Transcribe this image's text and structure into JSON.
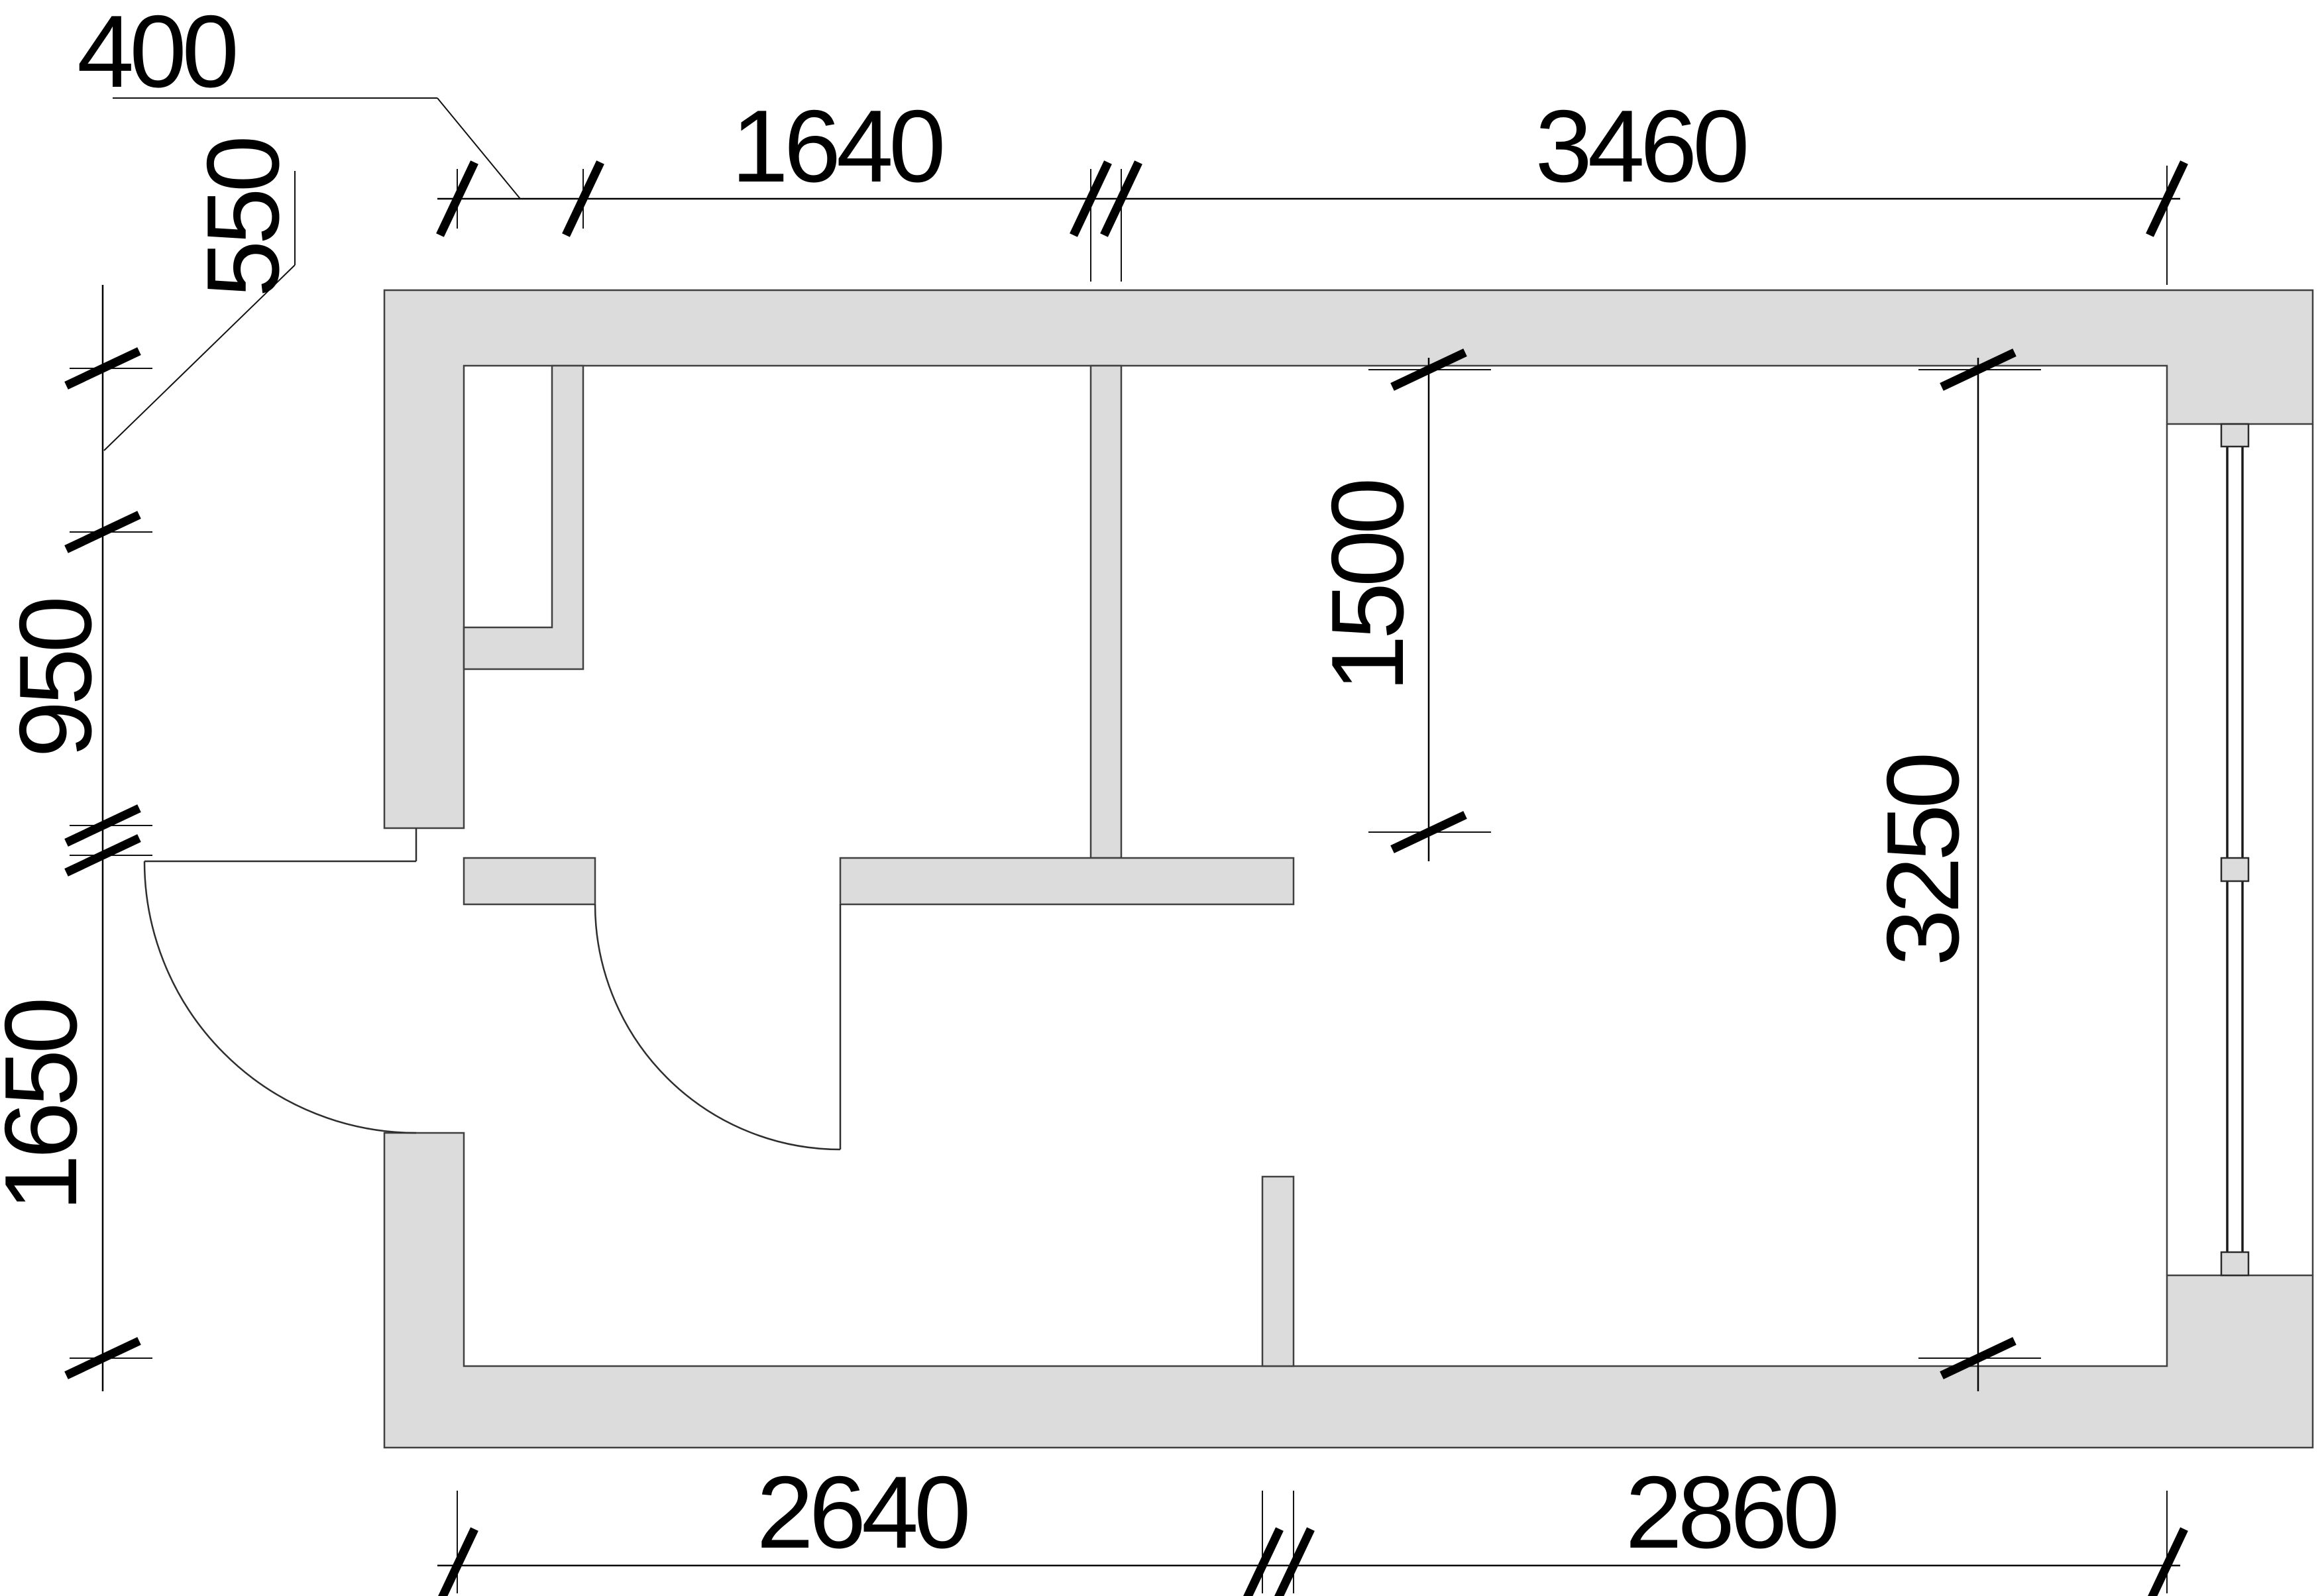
{
  "drawing": {
    "type": "architectural floor plan"
  },
  "dims": {
    "top": {
      "d400": "400",
      "d1640": "1640",
      "d3460": "3460"
    },
    "left": {
      "d550": "550",
      "d950": "950",
      "d1650": "1650"
    },
    "bottom": {
      "d2640": "2640",
      "d2860": "2860"
    },
    "interior": {
      "d1500": "1500",
      "d3250": "3250"
    }
  },
  "colors": {
    "wall_fill": "#dcdcdc",
    "wall_outline": "#404040",
    "dim_color": "#000000",
    "background": "#ffffff"
  }
}
